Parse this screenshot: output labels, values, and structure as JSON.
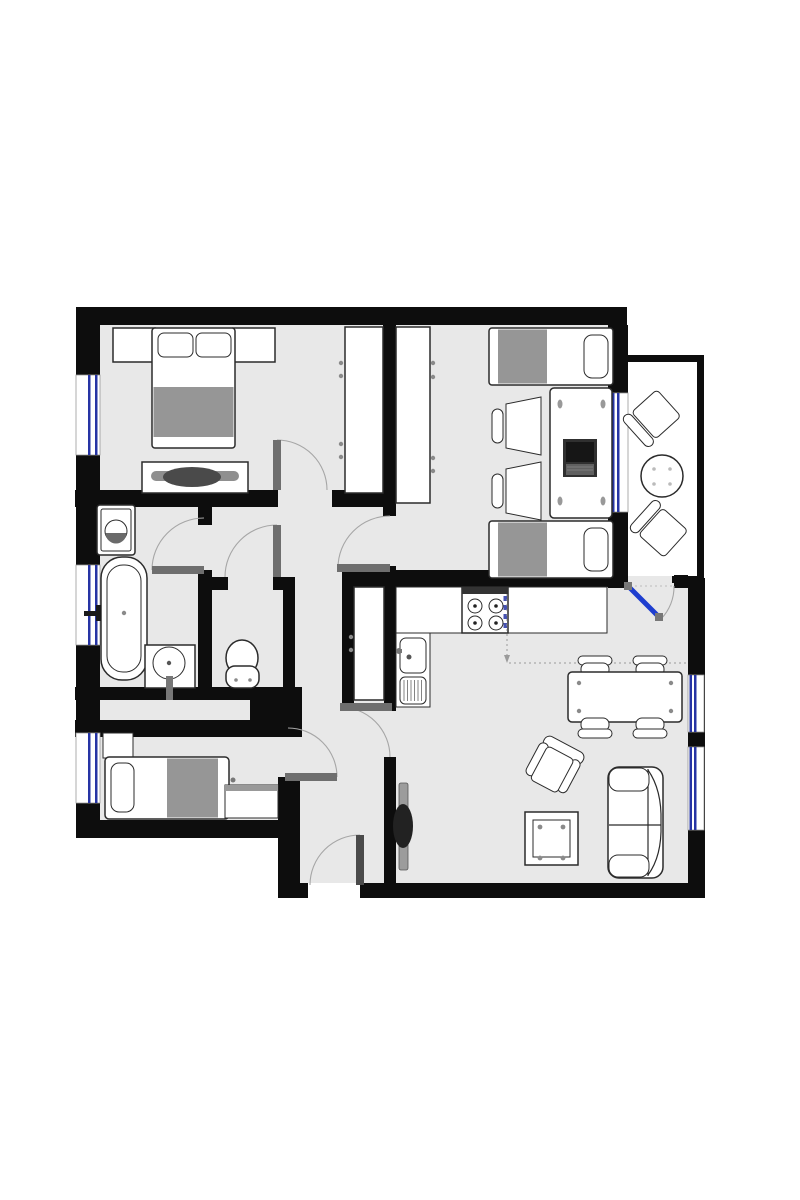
{
  "document": {
    "kind": "apartment-floor-plan",
    "has_text_labels": false
  },
  "colors": {
    "wall": "#0d0d0d",
    "floor": "#e8e8e8",
    "balcony_floor": "#ffffff",
    "furniture_fill": "#ffffff",
    "furniture_stroke": "#2b2b2b",
    "blanket": "#969696",
    "window_blue": "#2634a4",
    "balcony_door_blue": "#1e3ecf",
    "door_leaf": "#6e6e6e",
    "door_leaf_dark": "#4a4a4a",
    "swing_arc": "#a6a6a6",
    "handle_dot": "#8a8a8a",
    "dresser_bar": "#8f8f8f",
    "dresser_decor": "#4a4a4a",
    "tv_body": "#9c9c9c",
    "tv_screen": "#222222",
    "laptop_body": "#303030",
    "laptop_screen": "#161616",
    "laptop_keys": "#606060",
    "stove_band": "#333333",
    "dim_line": "#9a9a9a"
  },
  "rooms": [
    {
      "name": "bedroom-main",
      "position": "top-left",
      "furniture": [
        "double-bed",
        "pillow",
        "pillow",
        "nightstand",
        "nightstand",
        "dresser",
        "wardrobe",
        "window",
        "door"
      ]
    },
    {
      "name": "bedroom-twin",
      "position": "top-right",
      "furniture": [
        "single-bed",
        "single-bed",
        "desk",
        "laptop",
        "desk-chair",
        "desk-chair",
        "wardrobe",
        "window",
        "door"
      ]
    },
    {
      "name": "balcony",
      "position": "right",
      "furniture": [
        "patio-chair",
        "patio-chair",
        "round-table",
        "glass-door"
      ]
    },
    {
      "name": "bathroom",
      "position": "left-middle",
      "furniture": [
        "washing-machine",
        "bathtub",
        "wash-basin",
        "window",
        "door"
      ]
    },
    {
      "name": "wc",
      "position": "middle",
      "furniture": [
        "toilet",
        "door"
      ]
    },
    {
      "name": "kitchen-living-room",
      "position": "bottom-right",
      "furniture": [
        "kitchen-counter",
        "stove-4-burners",
        "kitchen-sink",
        "tall-cabinet",
        "dining-table",
        "dining-chair",
        "dining-chair",
        "dining-chair",
        "dining-chair",
        "sofa",
        "armchair",
        "coffee-table",
        "tv",
        "window",
        "window",
        "door"
      ]
    },
    {
      "name": "bedroom-small",
      "position": "bottom-left",
      "furniture": [
        "single-bed",
        "side-table",
        "desk",
        "window",
        "door"
      ]
    },
    {
      "name": "hallway",
      "position": "center",
      "furniture": [
        "entrance-door"
      ]
    }
  ]
}
